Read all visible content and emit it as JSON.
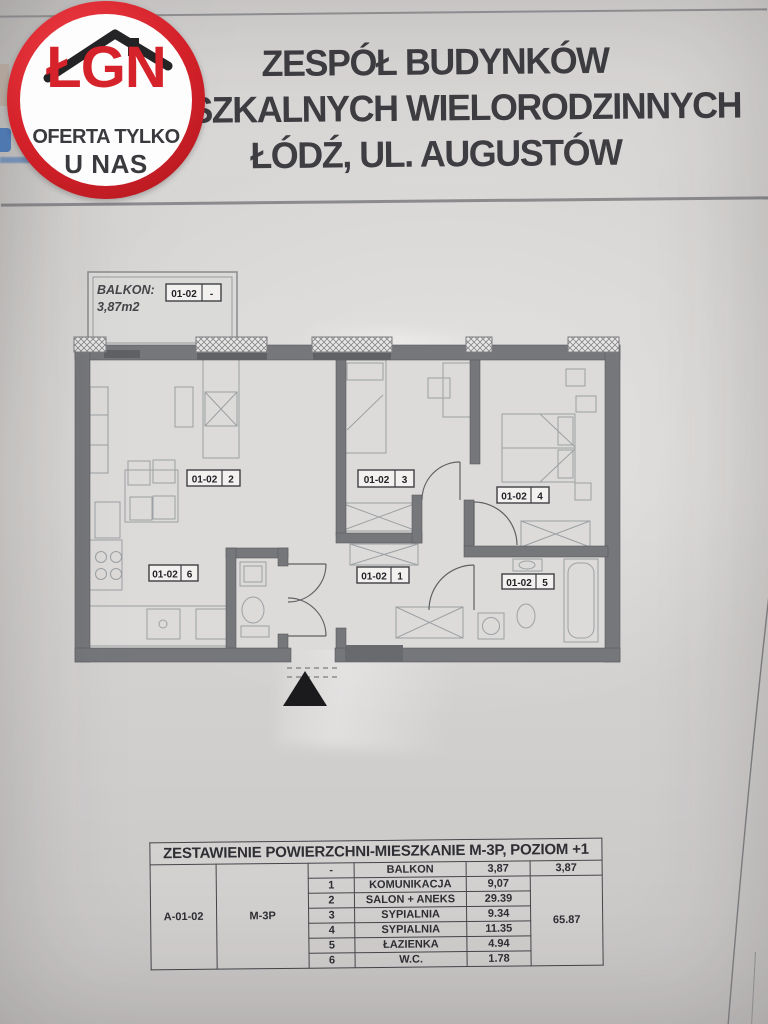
{
  "logo": {
    "brand": "ŁGN",
    "tagline1": "OFERTA TYLKO",
    "tagline2": "U NAS"
  },
  "header": {
    "line1": "ZESPÓŁ BUDYNKÓW",
    "line2": "MIESZKALNYCH WIELORODZINNYCH",
    "line3": "ŁÓDŹ, UL. AUGUSTÓW"
  },
  "plan": {
    "balcony": {
      "label": "BALKON:",
      "area": "3,87m2"
    },
    "labels": [
      {
        "unit": "01-02",
        "num": "-"
      },
      {
        "unit": "01-02",
        "num": "2"
      },
      {
        "unit": "01-02",
        "num": "3"
      },
      {
        "unit": "01-02",
        "num": "4"
      },
      {
        "unit": "01-02",
        "num": "1"
      },
      {
        "unit": "01-02",
        "num": "5"
      },
      {
        "unit": "01-02",
        "num": "6"
      }
    ]
  },
  "table": {
    "title": "ZESTAWIENIE POWIERZCHNI-MIESZKANIE M-3P, POZIOM +1",
    "unit_id": "A-01-02",
    "apartment_type": "M-3P",
    "rows": [
      {
        "no": "-",
        "name": "BALKON",
        "area": "3,87"
      },
      {
        "no": "1",
        "name": "KOMUNIKACJA",
        "area": "9,07"
      },
      {
        "no": "2",
        "name": "SALON + ANEKS",
        "area": "29.39"
      },
      {
        "no": "3",
        "name": "SYPIALNIA",
        "area": "9.34"
      },
      {
        "no": "4",
        "name": "SYPIALNIA",
        "area": "11.35"
      },
      {
        "no": "5",
        "name": "ŁAZIENKA",
        "area": "4.94"
      },
      {
        "no": "6",
        "name": "W.C.",
        "area": "1.78"
      }
    ],
    "balcony_total": "3,87",
    "living_total": "65.87"
  },
  "colors": {
    "logo_red": "#d6232b",
    "wall_gray": "#76777b",
    "paper": "#d8d6d4",
    "ink": "#3d3d42",
    "table_line": "#45454a",
    "triangle": "#1b1b1d",
    "peek_blue": "#3c6db0"
  }
}
